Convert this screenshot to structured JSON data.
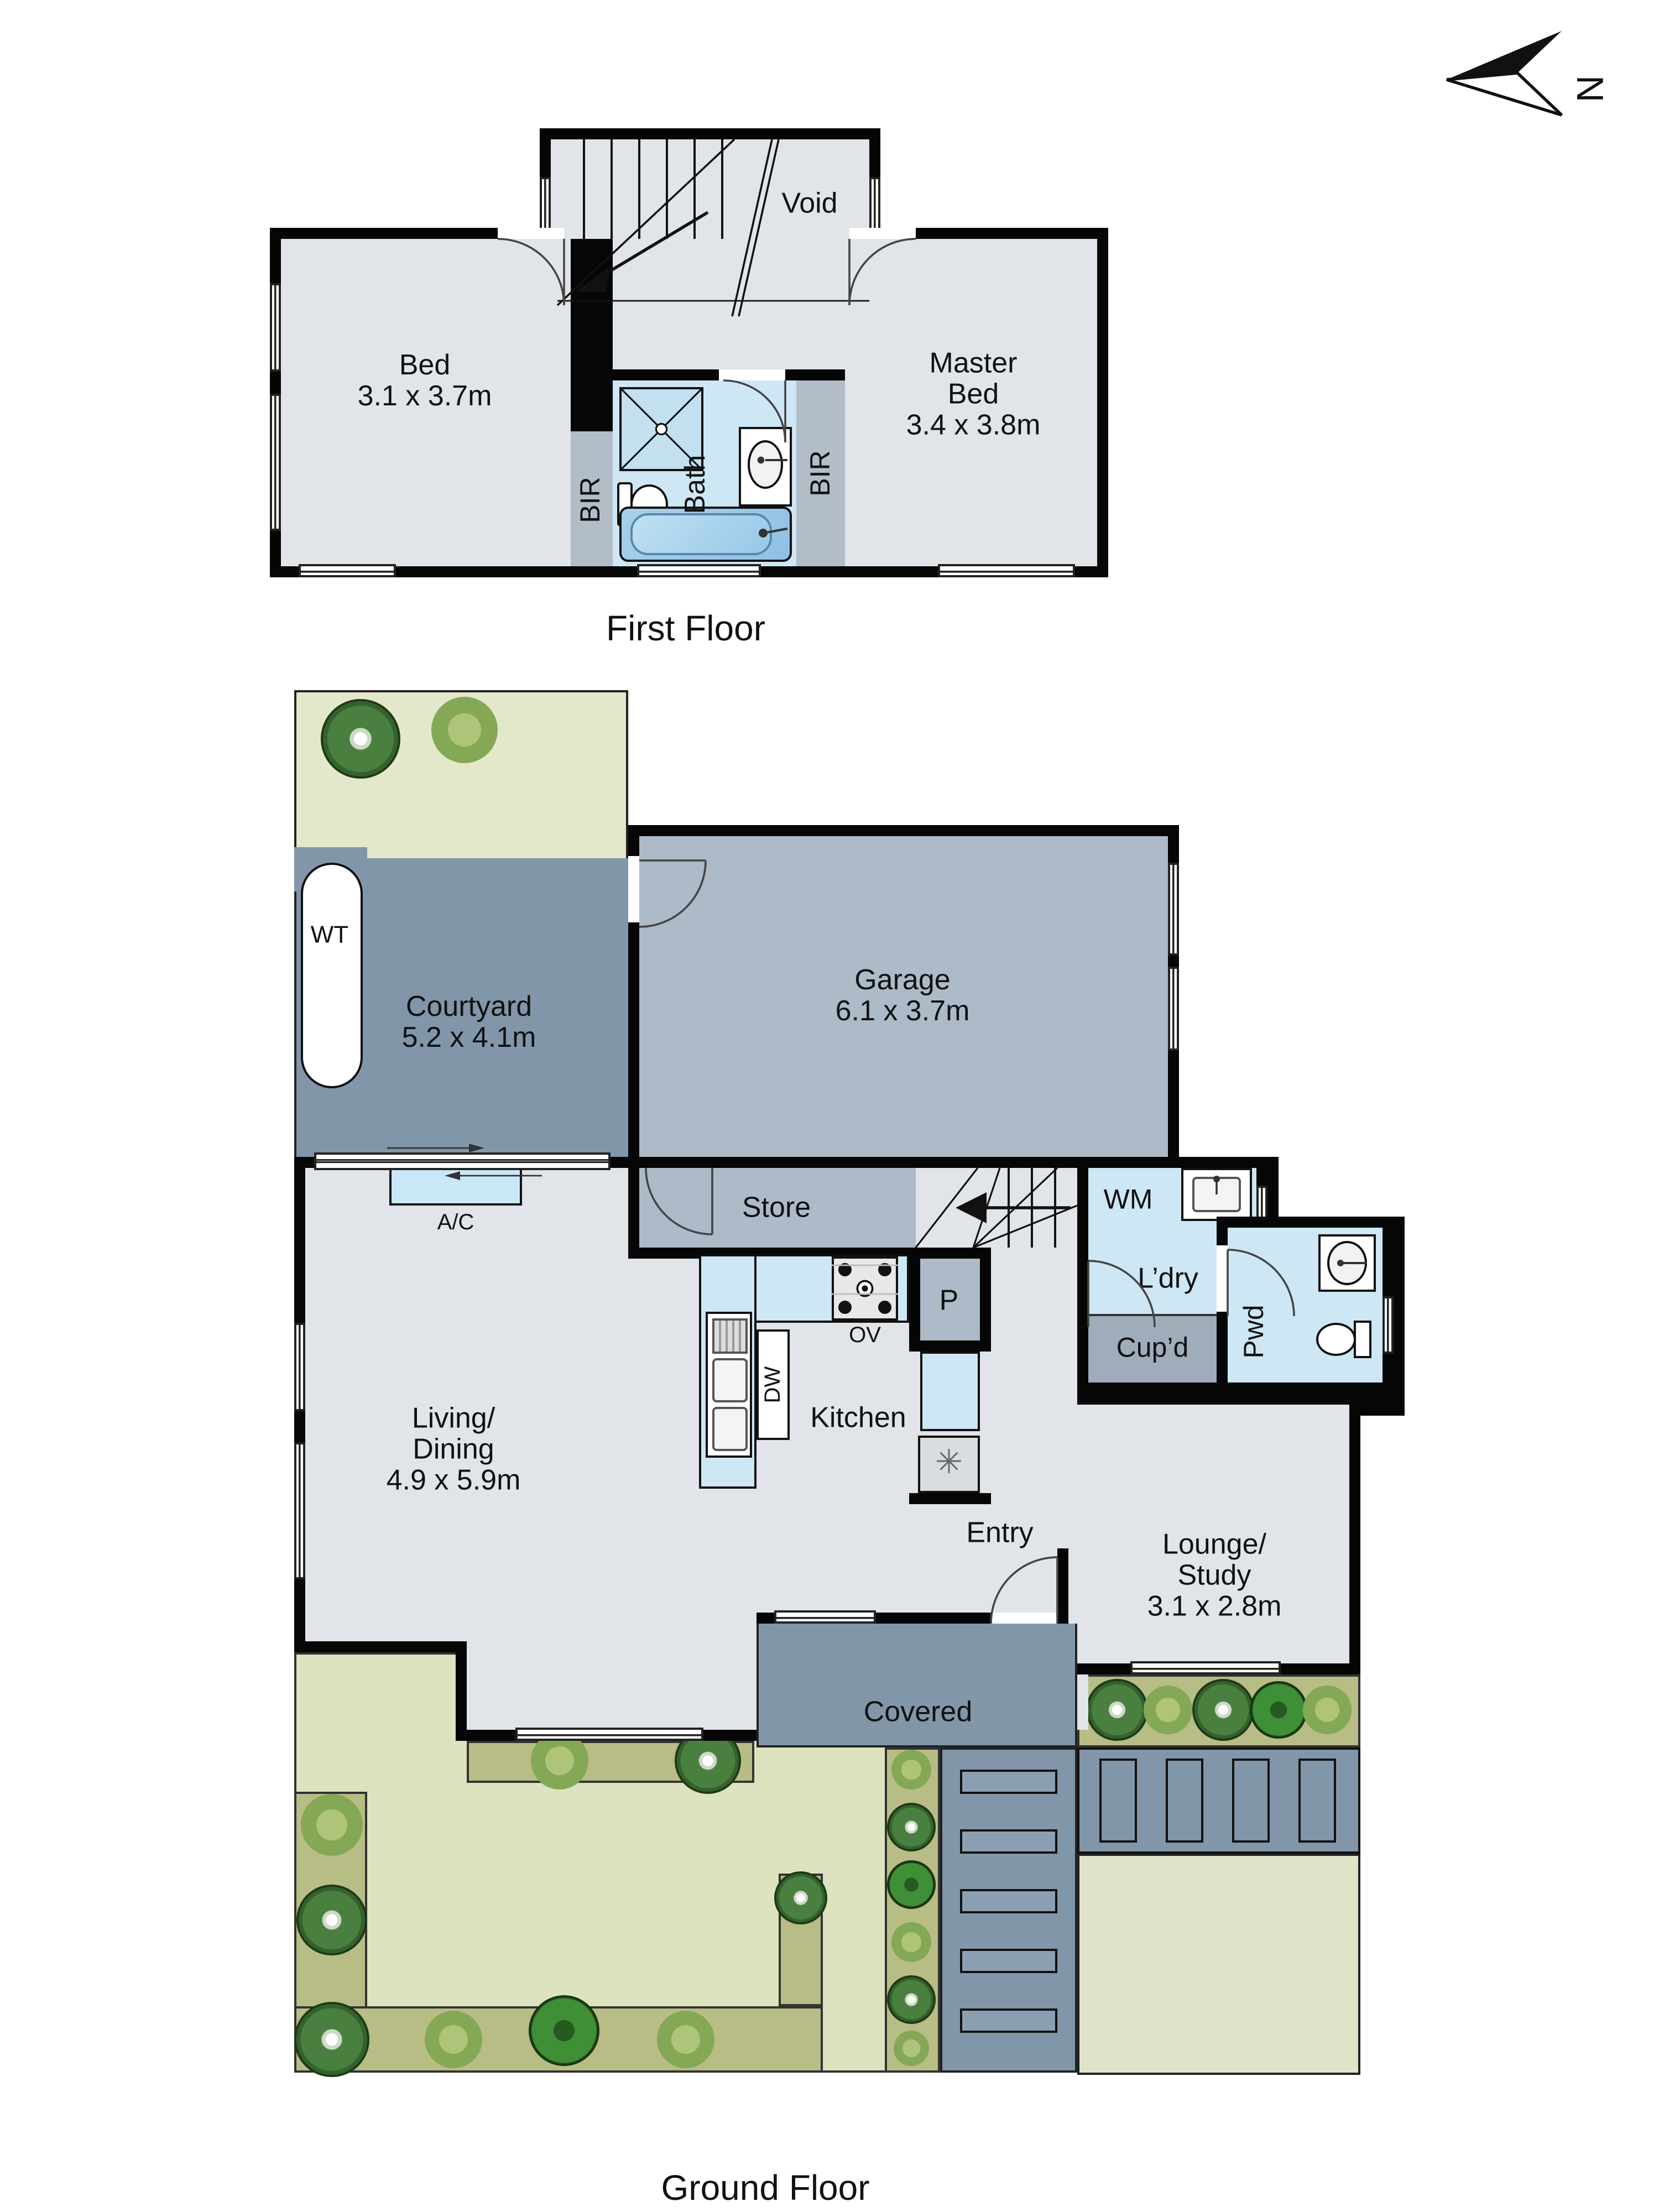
{
  "compass": {
    "letter": "N"
  },
  "palette": {
    "wall": "#060606",
    "floor": "#e1e5e9",
    "wet_area": "#cde7f5",
    "tub": "#9ccbe9",
    "robe": "#b2bdc7",
    "utility": "#adbac8",
    "outdoor_paved": "#8197a9",
    "garden_light": "#e4e8ca",
    "lawn": "#dde3bf",
    "garden_bed": "#b7bd85",
    "driveway": "#dfe4c9"
  },
  "first_floor": {
    "title": "First Floor",
    "void_label": "Void",
    "bed_name": "Bed",
    "bed_dims": "3.1 x 3.7m",
    "master_name1": "Master",
    "master_name2": "Bed",
    "master_dims": "3.4 x 3.8m",
    "bath_label": "Bath",
    "bir_left": "BIR",
    "bir_right": "BIR"
  },
  "ground_floor": {
    "title": "Ground Floor",
    "wt_label": "WT",
    "courtyard_name": "Courtyard",
    "courtyard_dims": "5.2 x 4.1m",
    "garage_name": "Garage",
    "garage_dims": "6.1 x 3.7m",
    "store_label": "Store",
    "ac_label": "A/C",
    "living1": "Living/",
    "living2": "Dining",
    "living_dims": "4.9 x 5.9m",
    "kitchen_label": "Kitchen",
    "dw_label": "DW",
    "ov_label": "OV",
    "pantry_label": "P",
    "fridge_symbol": "✳",
    "wm_label": "WM",
    "laundry_label": "L’dry",
    "cupboard_label": "Cup’d",
    "powder_label": "Pwd",
    "entry_label": "Entry",
    "lounge1": "Lounge/",
    "lounge2": "Study",
    "lounge_dims": "3.1 x 2.8m",
    "covered_label": "Covered"
  }
}
